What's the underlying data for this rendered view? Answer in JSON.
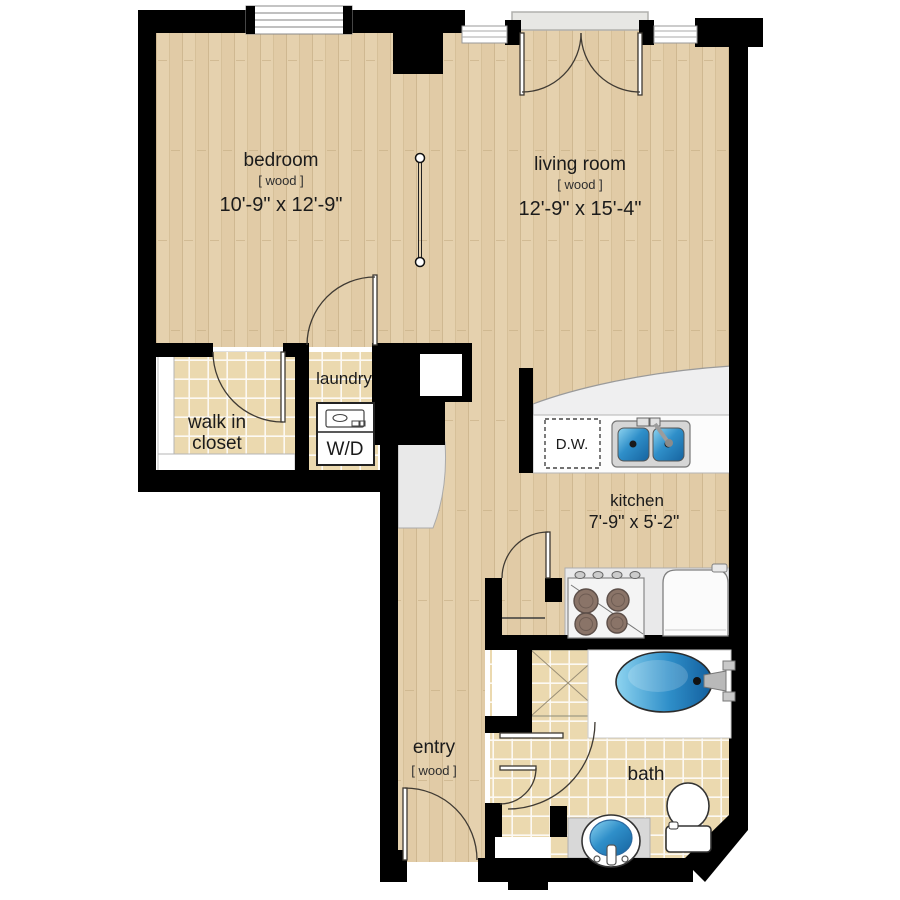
{
  "title": "apartment-floor-plan",
  "rooms": {
    "bedroom": {
      "label": "bedroom",
      "floor": "[ wood ]",
      "dimensions": "10'-9\" x 12'-9\""
    },
    "living_room": {
      "label": "living room",
      "floor": "[ wood ]",
      "dimensions": "12'-9\" x 15'-4\""
    },
    "kitchen": {
      "label": "kitchen",
      "dimensions": "7'-9\" x 5'-2\""
    },
    "laundry": {
      "label": "laundry"
    },
    "walk_in_closet": {
      "label_line1": "walk in",
      "label_line2": "closet"
    },
    "entry": {
      "label": "entry",
      "floor": "[ wood ]"
    },
    "bath": {
      "label": "bath"
    }
  },
  "appliances": {
    "washer_dryer": "W/D",
    "dishwasher": "D.W."
  },
  "colors": {
    "wood_floor": "#e5d1ae",
    "tile_floor": "#ebd9af",
    "wall": "#000000",
    "fixture_blue": "#2f8fc9",
    "counter_gray": "#efeff0"
  }
}
